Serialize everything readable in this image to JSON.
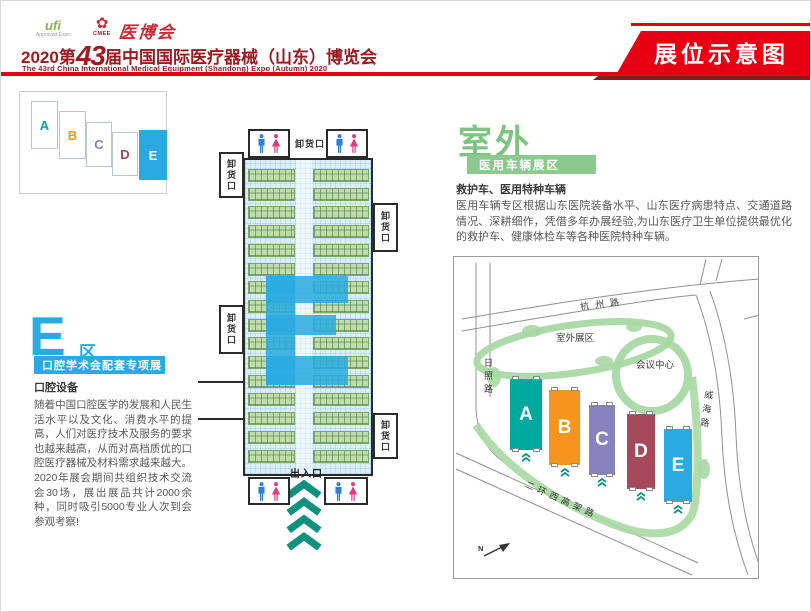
{
  "page": {
    "tag": "展位示意图"
  },
  "header": {
    "logo_ufi": "ufi",
    "logo_ufi_sub": "Approved Expo",
    "logo_cmee": "CMEE",
    "logo_flower": "✿",
    "logo_calligraphy": "医博会",
    "title_year": "2020第",
    "title_number": "43",
    "title_rest": "届中国国际医疗器械（山东）博览会",
    "subtitle_en": "The 43rd China International Medical Equipment (Shandong) Expo (Autumn) 2020"
  },
  "hall_e_section": {
    "big_letter": "E",
    "zone_char": "区",
    "banner": "口腔学术会配套专项展",
    "heading": "口腔设备",
    "body": "随着中国口腔医学的发展和人民生活水平以及文化、消费水平的提高，人们对医疗技术及服务的要求也越来越高，从而对高档质优的口腔医疗器械及材料需求越来越大。2020年展会期间共组织技术交流会30场，展出展品共计2000余种，同时吸引5000专业人次到会参观考察!"
  },
  "floorplan": {
    "unload_label": "卸货口",
    "entrance_label": "出入口"
  },
  "outdoor_section": {
    "big_title": "室外",
    "banner": "医用车辆展区",
    "heading": "救护车、医用特种车辆",
    "body": "医用车辆专区根据山东医院装备水平、山东医疗病患特点、交通道路情况、深耕细作，凭借多年办展经验,为山东医疗卫生单位提供最优化的救护车、健康体检车等各种医院特种车辆。"
  },
  "site_map": {
    "road_north": "杭州路",
    "road_west": "日照路",
    "road_east": "威海路",
    "road_south": "二环西高架路",
    "outdoor_area": "室外展区",
    "conference_center": "会议中心",
    "compass": "N",
    "halls": [
      {
        "label": "A",
        "color": "#00A99D"
      },
      {
        "label": "B",
        "color": "#F7941E"
      },
      {
        "label": "C",
        "color": "#8781BD"
      },
      {
        "label": "D",
        "color": "#A5495A"
      },
      {
        "label": "E",
        "color": "#29ABE2"
      }
    ]
  },
  "colors": {
    "accent_red": "#E60012",
    "dark_red": "#9C1B20",
    "cyan": "#29ABE2",
    "green": "#7CC47F",
    "arrow_teal": "#10917E"
  }
}
